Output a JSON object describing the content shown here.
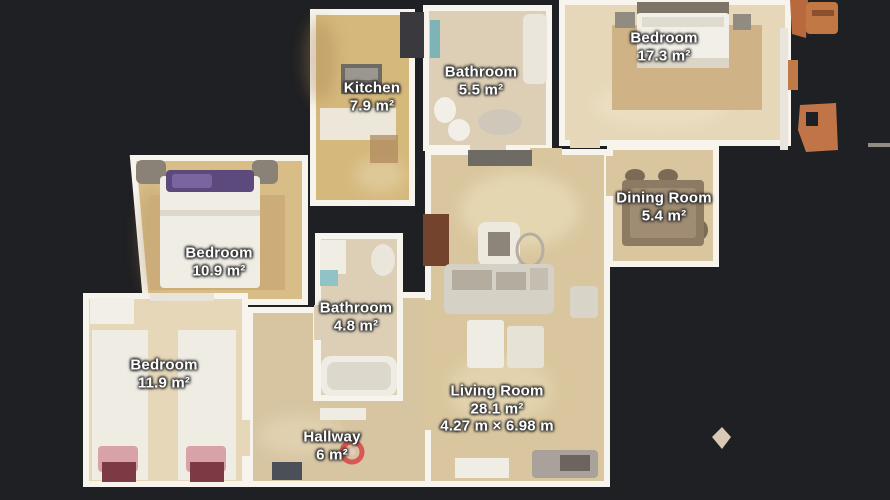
{
  "view": {
    "type": "floorplan-top-view"
  },
  "rooms": {
    "kitchen": {
      "name": "Kitchen",
      "area": "7.9 m²"
    },
    "bathroom_top": {
      "name": "Bathroom",
      "area": "5.5 m²"
    },
    "bedroom_large": {
      "name": "Bedroom",
      "area": "17.3 m²"
    },
    "dining": {
      "name": "Dining Room",
      "area": "5.4 m²"
    },
    "bedroom_mid": {
      "name": "Bedroom",
      "area": "10.9 m²"
    },
    "bathroom_small": {
      "name": "Bathroom",
      "area": "4.8 m²"
    },
    "bedroom_twin": {
      "name": "Bedroom",
      "area": "11.9 m²"
    },
    "hallway": {
      "name": "Hallway",
      "area": "6 m²"
    },
    "living": {
      "name": "Living Room",
      "area": "28.1 m²",
      "dimensions": "4.27 m × 6.98 m"
    }
  },
  "colors": {
    "bg": "#1f2023",
    "wall": "#f7f4ee",
    "floor-gold": "#d5b87c",
    "floor-gold2": "#d8bd87",
    "floor-cream": "#e5d7b8",
    "floor-pale": "#dccfb6",
    "floor-tan": "#d9c69e",
    "floor-tan2": "#d7c5a2",
    "rug": "#cfb386",
    "marker": "#d94b4d",
    "label-text": "#ffffff"
  }
}
